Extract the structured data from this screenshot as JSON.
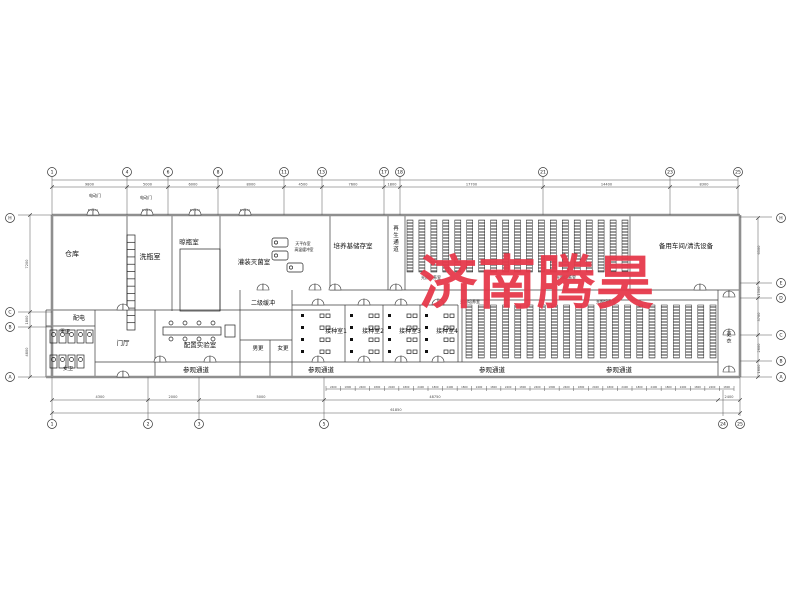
{
  "watermark": {
    "text": "济南腾昊",
    "color": "#e6394b"
  },
  "drawing": {
    "paper": {
      "w": 800,
      "h": 600,
      "bg": "#ffffff"
    },
    "door_tag": "M1521",
    "walls_thick": [
      [
        52,
        215,
        740,
        215
      ],
      [
        46,
        377,
        740,
        377
      ],
      [
        52,
        215,
        52,
        377
      ],
      [
        740,
        215,
        740,
        377
      ]
    ],
    "walls_thin": [
      [
        127,
        215,
        127,
        310
      ],
      [
        172,
        215,
        172,
        311
      ],
      [
        220,
        215,
        220,
        311
      ],
      [
        330,
        215,
        330,
        290
      ],
      [
        388,
        215,
        388,
        290
      ],
      [
        405,
        215,
        405,
        290
      ],
      [
        630,
        215,
        630,
        290
      ],
      [
        46,
        310,
        330,
        310
      ],
      [
        46,
        310,
        46,
        377
      ],
      [
        95,
        310,
        95,
        377
      ],
      [
        46,
        326,
        95,
        326
      ],
      [
        155,
        310,
        155,
        377
      ],
      [
        240,
        290,
        240,
        377
      ],
      [
        292,
        290,
        292,
        377
      ],
      [
        240,
        340,
        292,
        340
      ],
      [
        270,
        340,
        270,
        377
      ],
      [
        330,
        290,
        740,
        290
      ],
      [
        292,
        305,
        458,
        305
      ],
      [
        345,
        305,
        345,
        362
      ],
      [
        383,
        305,
        383,
        362
      ],
      [
        420,
        305,
        420,
        362
      ],
      [
        458,
        305,
        458,
        362
      ],
      [
        95,
        362,
        718,
        362
      ],
      [
        462,
        300,
        718,
        300
      ],
      [
        462,
        300,
        462,
        362
      ],
      [
        718,
        290,
        718,
        377
      ]
    ],
    "ext_lines": [
      [
        18,
        215,
        52,
        215
      ],
      [
        18,
        312,
        52,
        312
      ],
      [
        18,
        327,
        52,
        327
      ],
      [
        18,
        377,
        46,
        377
      ],
      [
        740,
        217,
        772,
        217
      ],
      [
        740,
        283,
        772,
        283
      ],
      [
        740,
        298,
        772,
        298
      ],
      [
        740,
        335,
        772,
        335
      ],
      [
        740,
        361,
        772,
        361
      ],
      [
        740,
        377,
        772,
        377
      ],
      [
        52,
        377,
        52,
        419
      ],
      [
        148,
        377,
        148,
        419
      ],
      [
        199,
        377,
        199,
        419
      ],
      [
        324,
        377,
        324,
        419
      ],
      [
        723,
        390,
        723,
        416
      ],
      [
        740,
        377,
        740,
        416
      ]
    ],
    "rack_blocks": [
      {
        "x": 407,
        "y": 220,
        "w": 221,
        "h": 52,
        "cols": 19
      },
      {
        "x": 466,
        "y": 305,
        "w": 250,
        "h": 53,
        "cols": 21
      }
    ],
    "hatch_rect": {
      "x": 180,
      "y": 249,
      "w": 40,
      "h": 62
    },
    "ladder": {
      "x": 127,
      "y": 235,
      "w": 8,
      "h": 95,
      "rungs": 13
    },
    "bench": {
      "x": 163,
      "y": 327,
      "w": 58,
      "h": 8,
      "stools": 4
    },
    "toilet_rows": [
      {
        "x": 50,
        "y": 330,
        "n": 5
      },
      {
        "x": 50,
        "y": 355,
        "n": 4
      }
    ],
    "machines": [
      [
        272,
        238
      ],
      [
        272,
        251
      ],
      [
        287,
        263
      ]
    ],
    "inoc_rooms": [
      {
        "x": 296
      },
      {
        "x": 345
      },
      {
        "x": 383
      },
      {
        "x": 420
      }
    ],
    "doors_top": [
      93,
      147,
      195,
      245
    ],
    "doors": [
      [
        315,
        290
      ],
      [
        335,
        290
      ],
      [
        396,
        290
      ],
      [
        700,
        290
      ],
      [
        729,
        297
      ],
      [
        729,
        335
      ],
      [
        729,
        372
      ],
      [
        318,
        305
      ],
      [
        364,
        305
      ],
      [
        401,
        305
      ],
      [
        438,
        305
      ],
      [
        318,
        362
      ],
      [
        364,
        362
      ],
      [
        401,
        362
      ],
      [
        438,
        362
      ],
      [
        123,
        310
      ],
      [
        123,
        377
      ],
      [
        263,
        290
      ],
      [
        160,
        362
      ],
      [
        210,
        362
      ]
    ],
    "labels": [
      [
        "仓库",
        72,
        256,
        7,
        0
      ],
      [
        "洗瓶室",
        150,
        259,
        7,
        0
      ],
      [
        "晾瓶室",
        189,
        244,
        6.5,
        0
      ],
      [
        "灌装灭菌室",
        254,
        264,
        6.5,
        0
      ],
      [
        "培养基储存室",
        353,
        248,
        6.5,
        0
      ],
      [
        "再生通道",
        396,
        230,
        5.5,
        1
      ],
      [
        "备用车间/清洗设备",
        686,
        248,
        6.5,
        0
      ],
      [
        "配电",
        79,
        320,
        6,
        0
      ],
      [
        "男卫",
        65,
        333,
        5,
        0
      ],
      [
        "女卫",
        68,
        370,
        5,
        0
      ],
      [
        "门厅",
        123,
        345,
        6.5,
        0
      ],
      [
        "配置实验室",
        200,
        347,
        6.5,
        0
      ],
      [
        "男更",
        258,
        350,
        5.5,
        0
      ],
      [
        "女更",
        283,
        350,
        5.5,
        0
      ],
      [
        "二级缓冲",
        263,
        305,
        6,
        0
      ],
      [
        "接种室1",
        336,
        333,
        6,
        0
      ],
      [
        "接种室2",
        373,
        333,
        6,
        0
      ],
      [
        "接种室3",
        410,
        333,
        6,
        0
      ],
      [
        "接种室4",
        447,
        333,
        6,
        0
      ],
      [
        "参观通道",
        196,
        372,
        6.5,
        0
      ],
      [
        "参观通道",
        321,
        372,
        6.5,
        0
      ],
      [
        "参观通道",
        492,
        372,
        6.5,
        0
      ],
      [
        "参观通道",
        619,
        372,
        6.5,
        0
      ],
      [
        "光照培养室",
        431,
        279,
        4,
        0
      ],
      [
        "光照培养室",
        566,
        279,
        4,
        0
      ],
      [
        "光照培养室",
        470,
        303,
        4,
        0
      ],
      [
        "光照培养室",
        606,
        303,
        4,
        0
      ],
      [
        "更衣",
        729,
        336,
        5,
        1
      ],
      [
        "电动门",
        95,
        197,
        4,
        0
      ],
      [
        "电动门",
        146,
        199,
        4,
        0
      ],
      [
        "天平存室",
        303,
        245,
        3.8,
        0
      ],
      [
        "高温缓冲室",
        304,
        251,
        3.8,
        0
      ]
    ],
    "grid_top": {
      "cy": 172,
      "line1_y": 180,
      "line2_y": 187,
      "bubbles": [
        [
          52,
          "1"
        ],
        [
          127,
          "4"
        ],
        [
          168,
          "6"
        ],
        [
          218,
          "8"
        ],
        [
          284,
          "11"
        ],
        [
          322,
          "13"
        ],
        [
          384,
          "17"
        ],
        [
          400,
          "18"
        ],
        [
          543,
          "21"
        ],
        [
          670,
          "23"
        ],
        [
          738,
          "25"
        ]
      ],
      "dims": [
        "9800",
        "5000",
        "6000",
        "8000",
        "4500",
        "7600",
        "1800",
        "17700",
        "14400",
        "8300"
      ]
    },
    "grid_bottom": {
      "cy": 424,
      "bubbles": [
        [
          52,
          "1"
        ],
        [
          148,
          "2"
        ],
        [
          199,
          "3"
        ],
        [
          324,
          "5"
        ],
        [
          723,
          "24"
        ],
        [
          740,
          "25"
        ]
      ],
      "dimline_y": 400,
      "ticks_x": [
        52,
        148,
        199,
        324,
        718,
        740
      ],
      "dims": [
        [
          "4300",
          100
        ],
        [
          "2000",
          173
        ],
        [
          "5000",
          261
        ],
        [
          "48750",
          435
        ],
        [
          "2400",
          729
        ]
      ],
      "total_y": 413,
      "total": [
        "61850",
        396
      ]
    },
    "tick_row": {
      "y": 389,
      "x1": 326,
      "x2": 734,
      "n": 28,
      "alt": [
        "2400",
        "1800"
      ]
    },
    "grid_left": {
      "cx": 10,
      "bubbles": [
        [
          218,
          "H"
        ],
        [
          312,
          "C"
        ],
        [
          327,
          "B"
        ],
        [
          377,
          "A"
        ]
      ],
      "dim_x": 30,
      "ticks": [
        215,
        312,
        327,
        377
      ],
      "dims": [
        [
          "7200",
          264
        ],
        [
          "1800",
          320
        ],
        [
          "4800",
          352
        ]
      ]
    },
    "grid_right": {
      "cx": 781,
      "bubbles": [
        [
          218,
          "H"
        ],
        [
          283,
          "E"
        ],
        [
          298,
          "D"
        ],
        [
          335,
          "C"
        ],
        [
          361,
          "B"
        ],
        [
          377,
          "A"
        ]
      ],
      "dim_x": 758,
      "ticks": [
        218,
        283,
        298,
        335,
        361,
        377
      ],
      "dims": [
        [
          "6500",
          250
        ],
        [
          "1500",
          291
        ],
        [
          "3700",
          317
        ],
        [
          "2600",
          348
        ],
        [
          "1600",
          369
        ]
      ]
    }
  }
}
